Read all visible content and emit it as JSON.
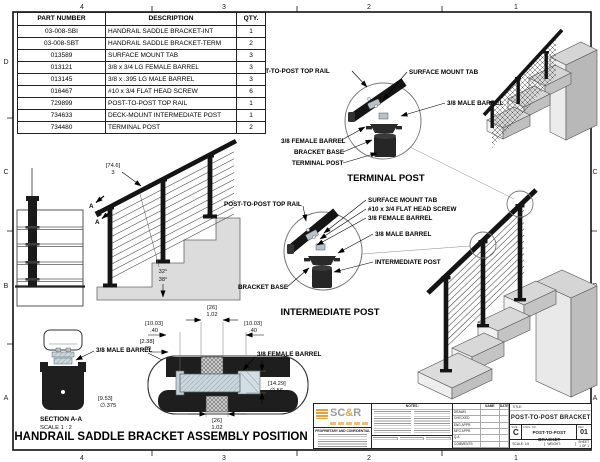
{
  "frame": {
    "cols": [
      "4",
      "3",
      "2",
      "1"
    ],
    "rows": [
      "D",
      "C",
      "B",
      "A"
    ]
  },
  "parts_table": {
    "headers": [
      "PART NUMBER",
      "DESCRIPTION",
      "QTY."
    ],
    "rows": [
      [
        "03-008-SBI",
        "HANDRAIL SADDLE BRACKET-INT",
        "1"
      ],
      [
        "03-008-SBT",
        "HANDRAIL SADDLE BRACKET-TERM",
        "2"
      ],
      [
        "013589",
        "SURFACE MOUNT TAB",
        "3"
      ],
      [
        "013121",
        "3/8 x 3/4 LG FEMALE BARREL",
        "3"
      ],
      [
        "013145",
        "3/8 x .395 LG MALE BARREL",
        "3"
      ],
      [
        "016467",
        "#10 x 3/4 FLAT HEAD SCREW",
        "6"
      ],
      [
        "729899",
        "POST-TO-POST TOP RAIL",
        "1"
      ],
      [
        "734633",
        "DECK-MOUNT INTERMEDIATE POST",
        "1"
      ],
      [
        "734480",
        "TERMINAL POST",
        "2"
      ]
    ]
  },
  "terminal_detail": {
    "title": "TERMINAL POST",
    "top_rail": "POST-TO-POST TOP RAIL",
    "surface_tab": "SURFACE MOUNT TAB",
    "male_barrel": "3/8 MALE BARREL",
    "female_barrel": "3/8 FEMALE BARREL",
    "bracket_base": "BRACKET BASE",
    "post": "TERMINAL POST"
  },
  "intermediate_detail": {
    "title": "INTERMEDIATE POST",
    "top_rail": "POST-TO-POST TOP RAIL",
    "surface_tab": "SURFACE MOUNT TAB",
    "screw": "#10 x 3/4 FLAT HEAD SCREW",
    "female_barrel": "3/8 FEMALE BARREL",
    "male_barrel": "3/8 MALE BARREL",
    "post": "INTERMEDIATE POST",
    "bracket_base": "BRACKET BASE"
  },
  "side_view": {
    "dim_mm": "[74.6]",
    "dim_in": "3",
    "angle_top": "32°",
    "angle_bottom": "38°",
    "section_label": "A"
  },
  "section_aa": {
    "title": "SECTION A-A",
    "scale": "SCALE 1 : 2",
    "male_barrel": "3/8 MALE BARREL",
    "dim_mm": "[9.53]",
    "dim_in": "∅.375"
  },
  "assembly": {
    "caption": "HANDRAIL SADDLE BRACKET ASSEMBLY POSITION",
    "female_barrel": "3/8 FEMALE BARREL",
    "dim_top_mm": "[26]",
    "dim_top_in": "1.02",
    "dim_left_mm": "[10.03]",
    "dim_left_in": ".40",
    "dim_left2_mm": "[2.38]",
    "dim_left2_in": ".09",
    "dim_right_mm": "[10.03]",
    "dim_right_in": ".40",
    "dim_h_mm": "[14.29]",
    "dim_h_in": "∅.56",
    "dim_bot_mm": "[26]",
    "dim_bot_in": "1.02"
  },
  "title_block": {
    "logo_sc": "SC",
    "logo_amp": "&",
    "logo_r": "R",
    "proprietary": "PROPRIETARY AND CONFIDENTIAL",
    "notes_label": "NOTES:",
    "name_col": "NAME",
    "date_col": "DATE",
    "approvals": [
      "DRAWN",
      "CHECKED",
      "ENG APPR.",
      "MFG APPR.",
      "Q.A.",
      "COMMENTS:"
    ],
    "title_label": "TITLE:",
    "title": "POST-TO-POST BRACKET",
    "size_label": "SIZE",
    "size": "C",
    "dwg_label": "DWG. NO.",
    "dwg_no": "POST-TO-POST BRACKET",
    "rev_label": "REV",
    "rev": "01",
    "scale": "SCALE: 1:8",
    "weight": "WEIGHT:",
    "sheet": "SHEET 1 OF 1"
  },
  "colors": {
    "accent_orange": "#e8a23c",
    "steel_blue": "#ccd6dd",
    "dark_metal": "#1f1f1f",
    "paper": "#ffffff"
  }
}
